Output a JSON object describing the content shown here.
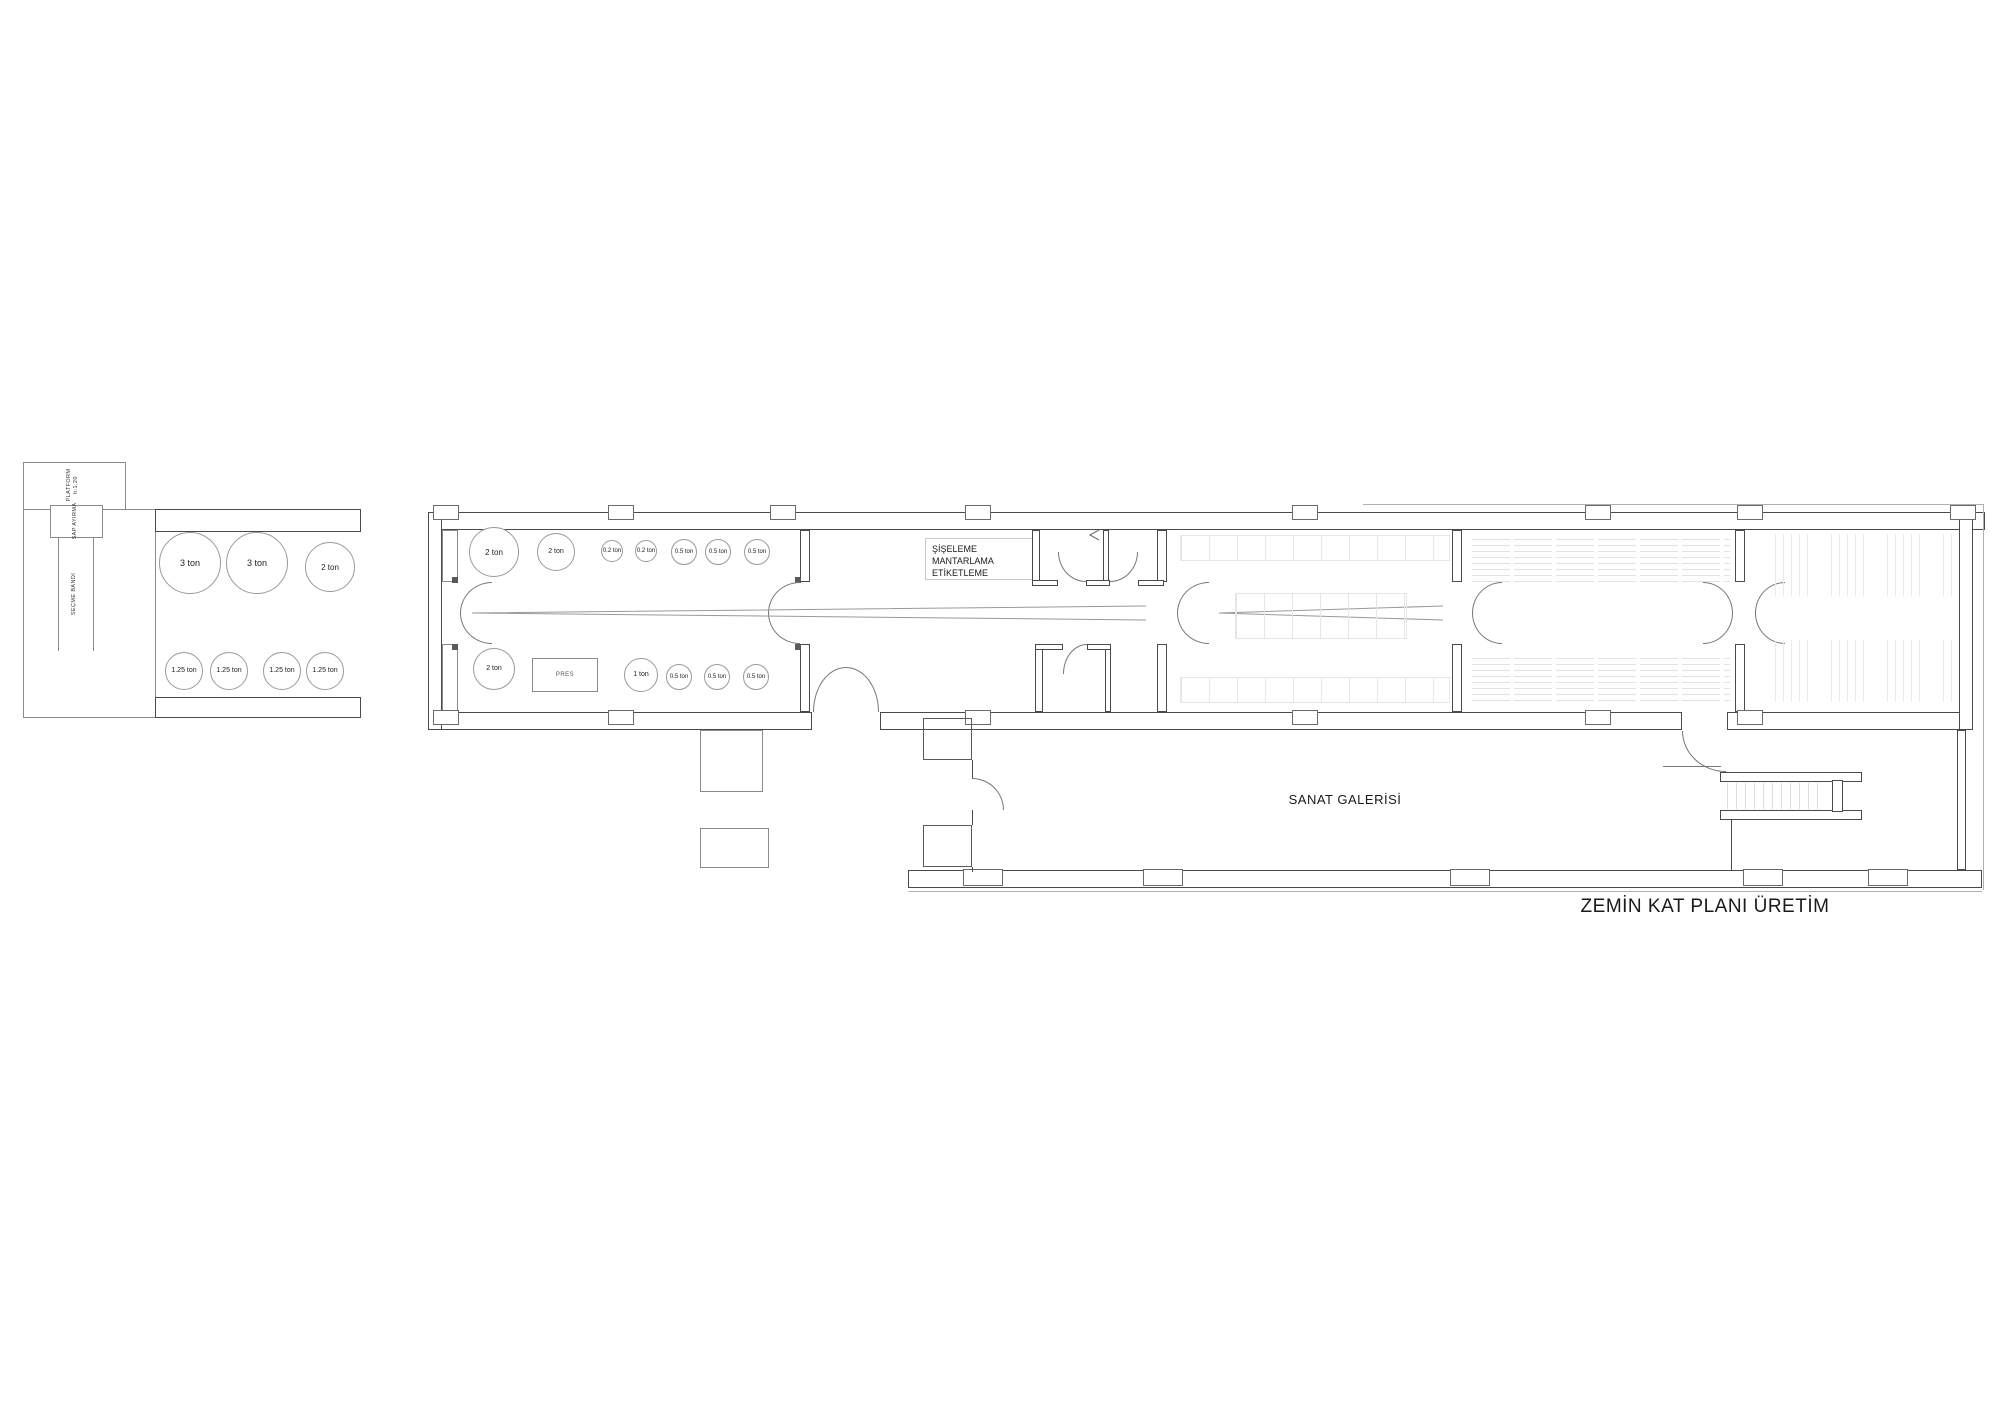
{
  "title": "ZEMİN KAT PLANI ÜRETİM",
  "intake": {
    "platform_label": "PLATFORM",
    "platform_height": "h:1.20",
    "sap_ayirma": "SAP AYIRMA",
    "secme_bandi": "SEÇME BANDI"
  },
  "fermentation": {
    "tanks_top": [
      "3 ton",
      "3 ton",
      "2 ton"
    ],
    "tanks_bottom": [
      "1.25 ton",
      "1.25 ton",
      "1.25 ton",
      "1.25 ton"
    ]
  },
  "press": {
    "label": "PRES",
    "tanks_top": [
      "2 ton",
      "2 ton",
      "0.2 ton",
      "0.2 ton",
      "0.5 ton",
      "0.5 ton",
      "0.5 ton"
    ],
    "tanks_bottom": [
      "2 ton",
      "1 ton",
      "0.5 ton",
      "0.5 ton",
      "0.5 ton"
    ]
  },
  "bottling": {
    "line1": "ŞİŞELEME",
    "line2": "MANTARLAMA",
    "line3": "ETİKETLEME"
  },
  "gallery": {
    "label": "SANAT GALERİSİ"
  },
  "colors": {
    "wall": "#4a4a4a",
    "light_wall": "#8a8a8a",
    "faint": "#e6e6e6",
    "text": "#1a1a1a"
  }
}
